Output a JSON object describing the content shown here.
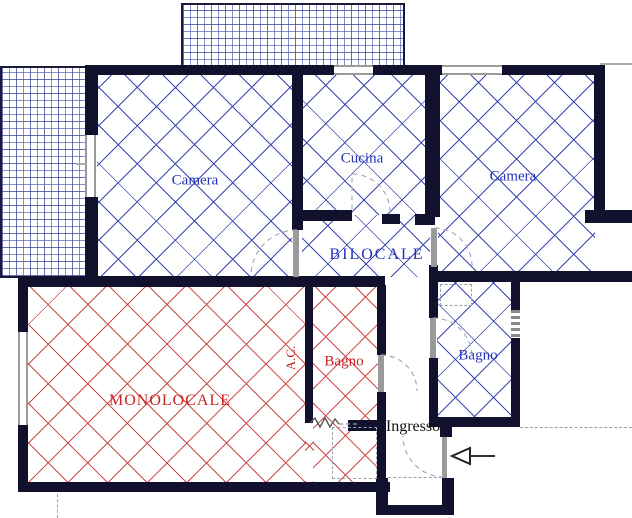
{
  "plan": {
    "type": "apartment-floor-plan",
    "units": [
      {
        "id": "bilocale",
        "label": "BILOCALE",
        "hatch_color": "#3a46b0",
        "text_color": "#2233bb"
      },
      {
        "id": "monolocale",
        "label": "MONOLOCALE",
        "hatch_color": "#cc4a4a",
        "text_color": "#cc2222"
      }
    ],
    "rooms": {
      "camera_left": {
        "label": "Camera",
        "unit": "bilocale"
      },
      "cucina": {
        "label": "Cucina",
        "unit": "bilocale"
      },
      "camera_right": {
        "label": "Camera",
        "unit": "bilocale"
      },
      "bagno_bilocale": {
        "label": "Bagno",
        "unit": "bilocale"
      },
      "corridor": {
        "label": "BILOCALE",
        "unit": "bilocale"
      },
      "monolocale_main": {
        "label": "MONOLOCALE",
        "unit": "monolocale"
      },
      "bagno_monolocale": {
        "label": "Bagno",
        "unit": "monolocale"
      },
      "ac_shaft": {
        "label": "A.C.",
        "unit": "monolocale"
      },
      "ingresso": {
        "label": "Ingresso",
        "unit": "shared"
      }
    },
    "icons": {
      "entrance_arrow_direction": "left"
    },
    "colors": {
      "wall": "#11112e",
      "blue-line": "#3a46b0",
      "red-line": "#cc4a4a",
      "blue-text": "#2233bb",
      "red-text": "#cc2222",
      "ink": "#111111",
      "door-gray": "#9a9a9a",
      "dash": "#9aa0b0"
    }
  }
}
